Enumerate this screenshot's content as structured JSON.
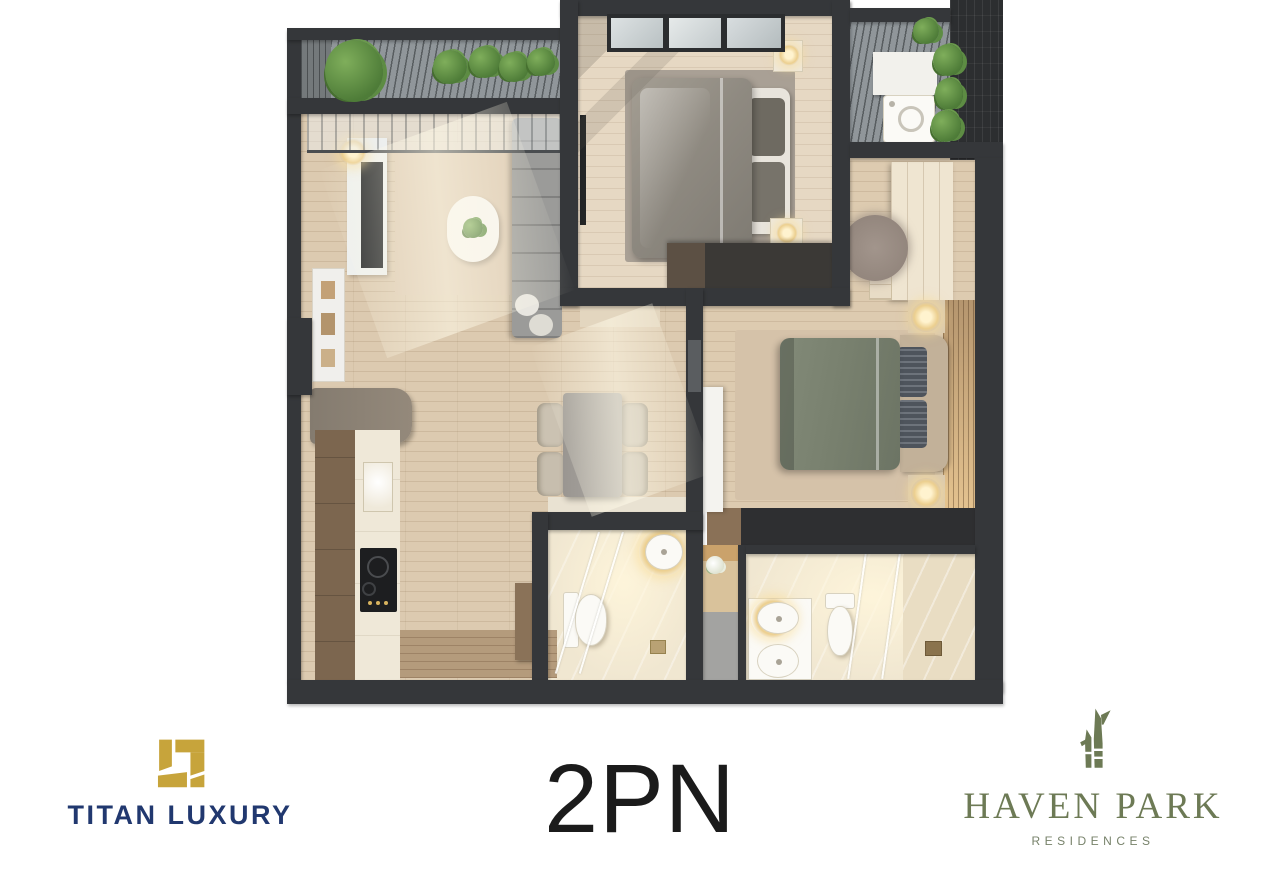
{
  "background_color": "#ffffff",
  "unit": {
    "label": "2PN",
    "text_color": "#1b1b1b"
  },
  "brands": {
    "titan": {
      "name": "TITAN LUXURY",
      "navy": "#21386f",
      "gold": "#c7a43b"
    },
    "haven": {
      "name": "HAVEN PARK",
      "subtitle": "RESIDENCES",
      "olive": "#6d7a55"
    }
  },
  "floor_plan": {
    "wall_color": "#35373a",
    "wood_floor_color": "#dccab0",
    "bath_tile_color": "#f1e8d3",
    "balcony_slat_color": "#90969a",
    "bed1_duvet_color": "#908b82",
    "bed2_duvet_color": "#78806e",
    "rooms": [
      "balcony-garden",
      "living-room",
      "kitchen",
      "dining-area",
      "bedroom-1",
      "laundry-balcony",
      "walk-in-closet",
      "bedroom-2",
      "bathroom-1",
      "bathroom-2"
    ]
  }
}
